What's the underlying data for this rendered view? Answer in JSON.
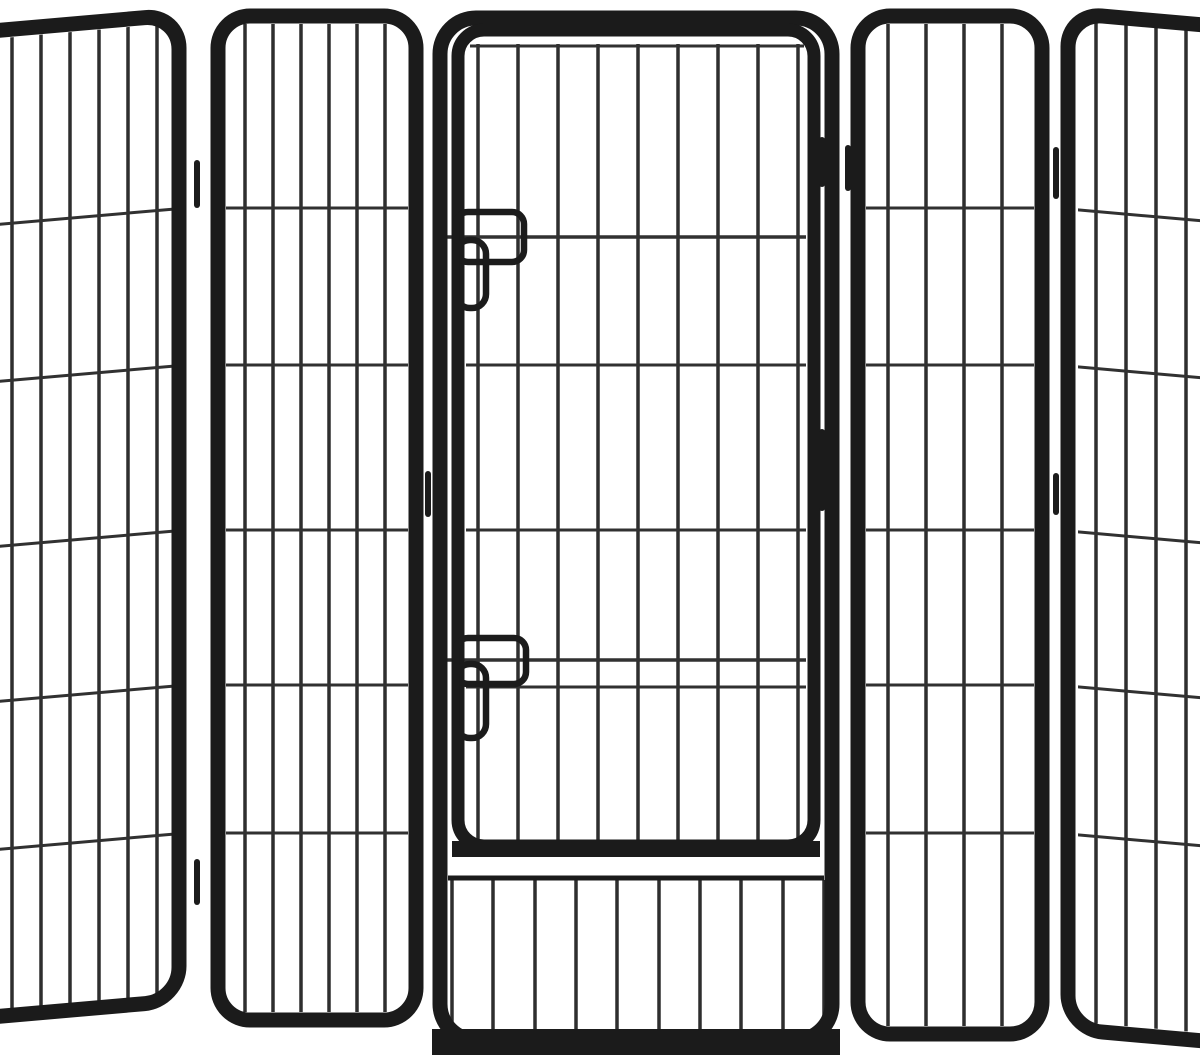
{
  "image": {
    "kind": "product-photo",
    "subject": "black heavy-duty metal pet playpen with five hinged wire panels; center panel has a gate door with two slide-bolt latches and a barred section below the door",
    "background_color": "#ffffff",
    "frame_color": "#1b1b1b",
    "bar_color": "#2e2e2e",
    "wire_color": "#313131"
  },
  "scene": {
    "canvas": {
      "width": 1200,
      "height": 1058
    },
    "panels": [
      {
        "name": "panel-far-left",
        "skew": {
          "deg": -5,
          "origin_x": 186
        },
        "rects": [
          {
            "name": "panel-frame",
            "x": -220,
            "y": 14,
            "w": 399,
            "h": 986,
            "rx": 34,
            "stroke": 15
          }
        ],
        "bar_sets": [
          {
            "name": "panel-bars",
            "xs": [
              12,
              41,
              70,
              99,
              128,
              157
            ],
            "y1": 22,
            "y2": 994,
            "stroke": 3.5
          }
        ],
        "wire_sets": [
          {
            "name": "panel-wires",
            "ys": [
              208,
              365,
              530,
              685,
              833
            ],
            "x1": -5,
            "x2": 172,
            "stroke": 3
          }
        ],
        "lines": []
      },
      {
        "name": "panel-left",
        "rects": [
          {
            "name": "panel-frame",
            "x": 218,
            "y": 16,
            "w": 198,
            "h": 1004,
            "rx": 32,
            "stroke": 15
          }
        ],
        "bar_sets": [
          {
            "name": "panel-bars",
            "xs": [
              245,
              273,
              301,
              329,
              357,
              385
            ],
            "y1": 24,
            "y2": 1012,
            "stroke": 3.5
          }
        ],
        "wire_sets": [
          {
            "name": "panel-wires",
            "ys": [
              208,
              365,
              530,
              685,
              833
            ],
            "x1": 226,
            "x2": 408,
            "stroke": 3
          }
        ],
        "lines": []
      },
      {
        "name": "panel-center-with-door",
        "rects": [
          {
            "name": "panel-frame",
            "x": 440,
            "y": 18,
            "w": 392,
            "h": 1022,
            "rx": 36,
            "stroke": 15
          },
          {
            "name": "door-frame",
            "x": 458,
            "y": 30,
            "w": 356,
            "h": 816,
            "rx": 26,
            "stroke": 13
          },
          {
            "name": "latch-top-housing",
            "x": 456,
            "y": 212,
            "w": 68,
            "h": 50,
            "rx": 12,
            "stroke": 6.5
          },
          {
            "name": "latch-top-bolt",
            "x": 456,
            "y": 240,
            "w": 30,
            "h": 68,
            "rx": 14,
            "stroke": 6.5
          },
          {
            "name": "latch-bottom-housing",
            "x": 456,
            "y": 638,
            "w": 70,
            "h": 46,
            "rx": 12,
            "stroke": 6.5
          },
          {
            "name": "latch-bottom-bolt",
            "x": 456,
            "y": 664,
            "w": 30,
            "h": 74,
            "rx": 14,
            "stroke": 6.5
          }
        ],
        "bar_sets": [
          {
            "name": "door-bars",
            "xs": [
              478,
              518,
              558,
              598,
              638,
              678,
              718,
              758,
              798
            ],
            "y1": 44,
            "y2": 840,
            "stroke": 3.5
          },
          {
            "name": "under-door-bars",
            "xs": [
              452,
              493,
              535,
              576,
              617,
              659,
              700,
              741,
              783,
              824
            ],
            "y1": 880,
            "y2": 1032,
            "stroke": 3.5
          }
        ],
        "wire_sets": [
          {
            "name": "door-wires",
            "ys": [
              365,
              530,
              687
            ],
            "x1": 466,
            "x2": 806,
            "stroke": 3
          },
          {
            "name": "latch-guide-wires",
            "ys": [
              237,
              660
            ],
            "x1": 434,
            "x2": 806,
            "stroke": 3.5
          },
          {
            "name": "door-top-wire",
            "ys": [
              46
            ],
            "x1": 470,
            "x2": 804,
            "stroke": 3
          }
        ],
        "lines": [
          {
            "name": "door-bottom-rail",
            "x1": 452,
            "y1": 849,
            "x2": 820,
            "y2": 849,
            "stroke": 16
          },
          {
            "name": "under-door-top-rail",
            "x1": 448,
            "y1": 878,
            "x2": 824,
            "y2": 878,
            "stroke": 5
          },
          {
            "name": "panel-bottom-rail",
            "x1": 432,
            "y1": 1042,
            "x2": 840,
            "y2": 1042,
            "stroke": 26
          }
        ]
      },
      {
        "name": "panel-right",
        "rects": [
          {
            "name": "panel-frame",
            "x": 858,
            "y": 16,
            "w": 184,
            "h": 1018,
            "rx": 32,
            "stroke": 15
          }
        ],
        "bar_sets": [
          {
            "name": "panel-bars",
            "xs": [
              888,
              926,
              964,
              1002
            ],
            "y1": 24,
            "y2": 1026,
            "stroke": 3.5
          }
        ],
        "wire_sets": [
          {
            "name": "panel-wires",
            "ys": [
              208,
              365,
              530,
              685,
              833
            ],
            "x1": 866,
            "x2": 1034,
            "stroke": 3
          }
        ],
        "lines": []
      },
      {
        "name": "panel-far-right",
        "skew": {
          "deg": 5,
          "origin_x": 1056
        },
        "rects": [
          {
            "name": "panel-frame",
            "x": 1068,
            "y": 12,
            "w": 380,
            "h": 1016,
            "rx": 34,
            "stroke": 15
          }
        ],
        "bar_sets": [
          {
            "name": "panel-bars",
            "xs": [
              1096,
              1126,
              1156,
              1186
            ],
            "y1": 18,
            "y2": 1020,
            "stroke": 3.5
          }
        ],
        "wire_sets": [
          {
            "name": "panel-wires",
            "ys": [
              208,
              365,
              530,
              685,
              833
            ],
            "x1": 1078,
            "x2": 1210,
            "stroke": 3
          }
        ],
        "lines": []
      },
      {
        "name": "hinges",
        "rects": [],
        "bar_sets": [],
        "wire_sets": [],
        "lines": [
          {
            "name": "hinge-left-top",
            "x1": 197,
            "y1": 163,
            "x2": 197,
            "y2": 205,
            "stroke": 6,
            "cap": "round"
          },
          {
            "name": "hinge-left-bottom",
            "x1": 197,
            "y1": 862,
            "x2": 197,
            "y2": 902,
            "stroke": 6,
            "cap": "round"
          },
          {
            "name": "hinge-mid-left",
            "x1": 428,
            "y1": 474,
            "x2": 428,
            "y2": 514,
            "stroke": 6,
            "cap": "round"
          },
          {
            "name": "door-hinge-top",
            "x1": 822,
            "y1": 140,
            "x2": 822,
            "y2": 184,
            "stroke": 6,
            "cap": "round"
          },
          {
            "name": "door-hinge-middle",
            "x1": 822,
            "y1": 432,
            "x2": 822,
            "y2": 508,
            "stroke": 6,
            "cap": "round"
          },
          {
            "name": "hinge-mid-right",
            "x1": 848,
            "y1": 148,
            "x2": 848,
            "y2": 188,
            "stroke": 6,
            "cap": "round"
          },
          {
            "name": "hinge-right-top",
            "x1": 1056,
            "y1": 150,
            "x2": 1056,
            "y2": 196,
            "stroke": 6,
            "cap": "round"
          },
          {
            "name": "hinge-right-mid",
            "x1": 1056,
            "y1": 476,
            "x2": 1056,
            "y2": 512,
            "stroke": 6,
            "cap": "round"
          }
        ]
      }
    ]
  }
}
